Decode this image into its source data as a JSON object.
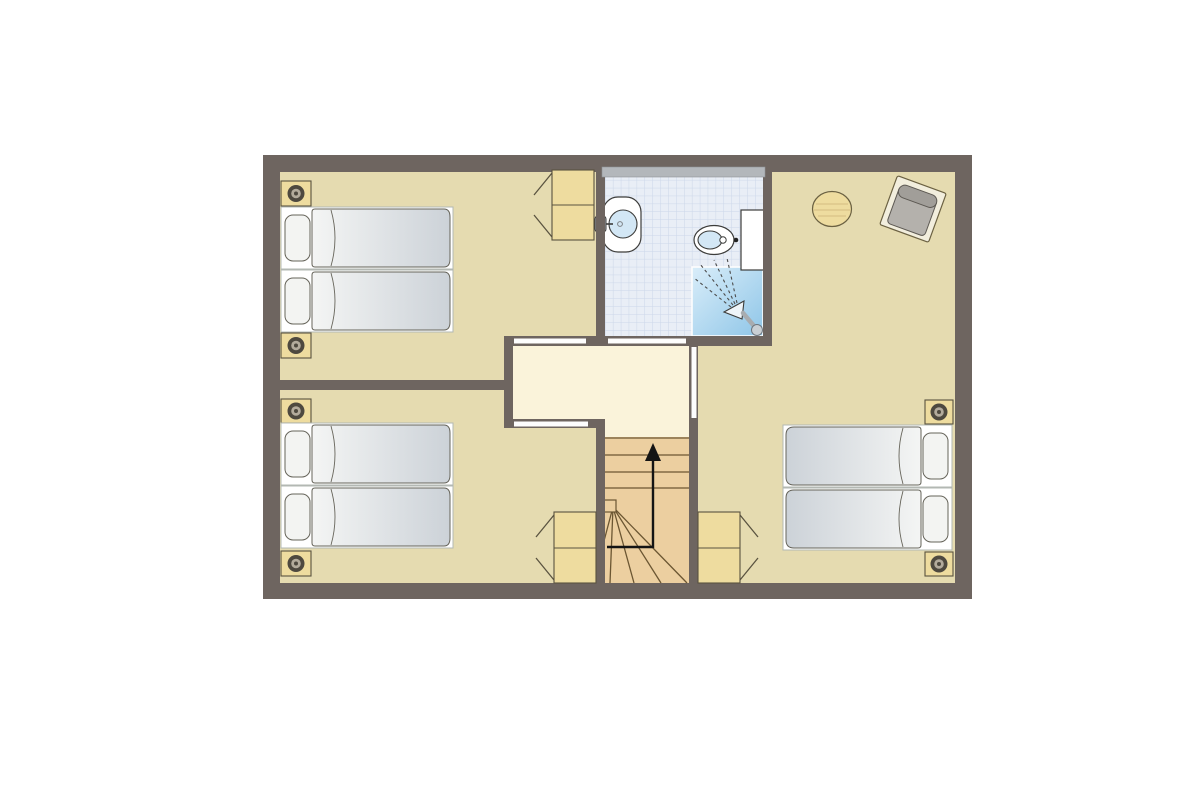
{
  "meta": {
    "type": "floor-plan",
    "description": "Upper-storey floor plan with three bedrooms, bathroom, landing and winder staircase",
    "background": "#ffffff",
    "text_labels": []
  },
  "palette": {
    "wall": "#6e6560",
    "floor": "#e5dbb0",
    "landing": "#faf3da",
    "stair_wood": "#eccfa0",
    "stair_line": "#6b5632",
    "wood": "#eedc9f",
    "wood_outline": "#5a5340",
    "tile": "#e9eef6",
    "tile_grid": "#ccd7e9",
    "shower_light": "#d9edf9",
    "shower_deep": "#8fc6e8",
    "fixture_outline": "#3d3d3b",
    "white": "#fdfdfd",
    "water": "#d3e7f5",
    "window": "#b3b7bb",
    "bed_outline": "#66645a",
    "bed_base_outline": "#b3b8b3",
    "duvet_light": "#f4f5f4",
    "duvet_dark": "#ccd2d8",
    "pillow": "#f3f4f2",
    "lamp_dark": "#4e493f",
    "lamp_mid": "#b3ab9c",
    "chair_frame": "#f2eedd",
    "chair_outline": "#6b6142",
    "cushion": "#b4b1ac",
    "cushion_roll": "#a19e99",
    "cushion_outline": "#5c5852",
    "arrow": "#141414",
    "table_grain": "#d4bd82",
    "metal": "#a8acb0",
    "spray": "#4c4c4c"
  },
  "rooms": [
    {
      "id": "bedroom-top-left",
      "name": "Bedroom top left",
      "furniture": [
        "single-bed",
        "single-bed",
        "nightstand-with-lamp",
        "nightstand-with-lamp",
        "two-door-wardrobe"
      ]
    },
    {
      "id": "bedroom-bottom-left",
      "name": "Bedroom bottom left",
      "furniture": [
        "single-bed",
        "single-bed",
        "nightstand-with-lamp",
        "nightstand-with-lamp",
        "two-door-wardrobe"
      ]
    },
    {
      "id": "bedroom-right",
      "name": "Bedroom right",
      "furniture": [
        "single-bed",
        "single-bed",
        "nightstand-with-lamp",
        "nightstand-with-lamp",
        "two-door-wardrobe",
        "round-side-table",
        "armchair"
      ]
    },
    {
      "id": "bathroom",
      "name": "Bathroom",
      "furniture": [
        "washbasin",
        "toilet-with-cistern",
        "shower",
        "window"
      ]
    },
    {
      "id": "landing",
      "name": "Landing",
      "furniture": [
        "winder-staircase",
        "up-direction-arrow"
      ]
    }
  ],
  "counts": {
    "beds": 6,
    "nightstands": 6,
    "wardrobes": 3,
    "doors": 4,
    "windows": 1
  },
  "icons": {
    "stair_direction": "up-arrow-icon",
    "shower_spray": "spray-lines-icon",
    "lamp": "lamp-ring-icon"
  }
}
